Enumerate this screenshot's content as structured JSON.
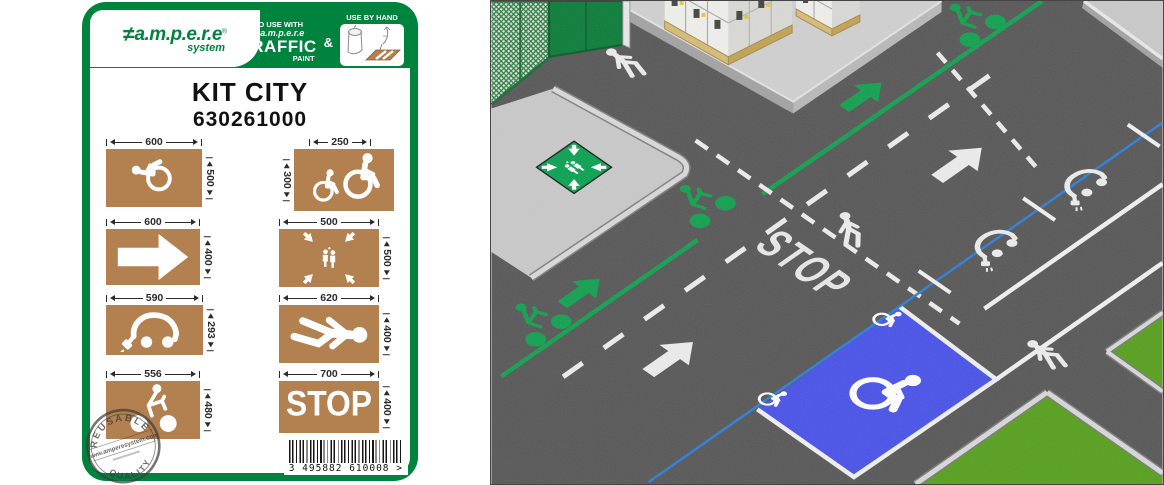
{
  "card": {
    "brand": {
      "glyph": "≠",
      "name": "a.m.p.e.r.e",
      "reg": "®",
      "sub": "system"
    },
    "header": {
      "to_use_with": "TO USE WITH",
      "brand_small": "≠ a.m.p.e.r.e",
      "traffic": "TRAFFIC",
      "paint": "PAINT",
      "amp": "&",
      "use_by_hand": "USE BY HAND"
    },
    "title": "KIT CITY",
    "ref": "630261000",
    "stencils": [
      {
        "name": "wheelchair",
        "width": "600",
        "height": "500"
      },
      {
        "name": "wheelchair-small",
        "width": "250",
        "height": "300"
      },
      {
        "name": "arrow-right",
        "width": "600",
        "height": "400"
      },
      {
        "name": "meeting-point",
        "width": "500",
        "height": "500"
      },
      {
        "name": "electric-car",
        "width": "590",
        "height": "293"
      },
      {
        "name": "pedestrian",
        "width": "620",
        "height": "400"
      },
      {
        "name": "cyclist",
        "width": "556",
        "height": "480"
      },
      {
        "name": "stop",
        "width": "700",
        "height": "400",
        "label": "STOP"
      }
    ],
    "stamp": {
      "top": "REUSABLE",
      "middle": "www.amperesystem.com",
      "bottom": "QUALITY"
    },
    "barcode": {
      "digits": "3 495882 610008",
      "suffix": ">"
    }
  },
  "scene": {
    "stop_marking": "STOP",
    "colors": {
      "asphalt": "#585858",
      "sidewalk": "#c9c9c9",
      "grass": "#57a01e",
      "handicap_blue": "#4953e8",
      "lane_green": "#12a150",
      "line_blue": "#2e7fd9",
      "marking_white": "#ececec",
      "stencil_brown": "#b3814f",
      "brand_green": "#00843d",
      "fence_green": "#1e6b38"
    }
  }
}
